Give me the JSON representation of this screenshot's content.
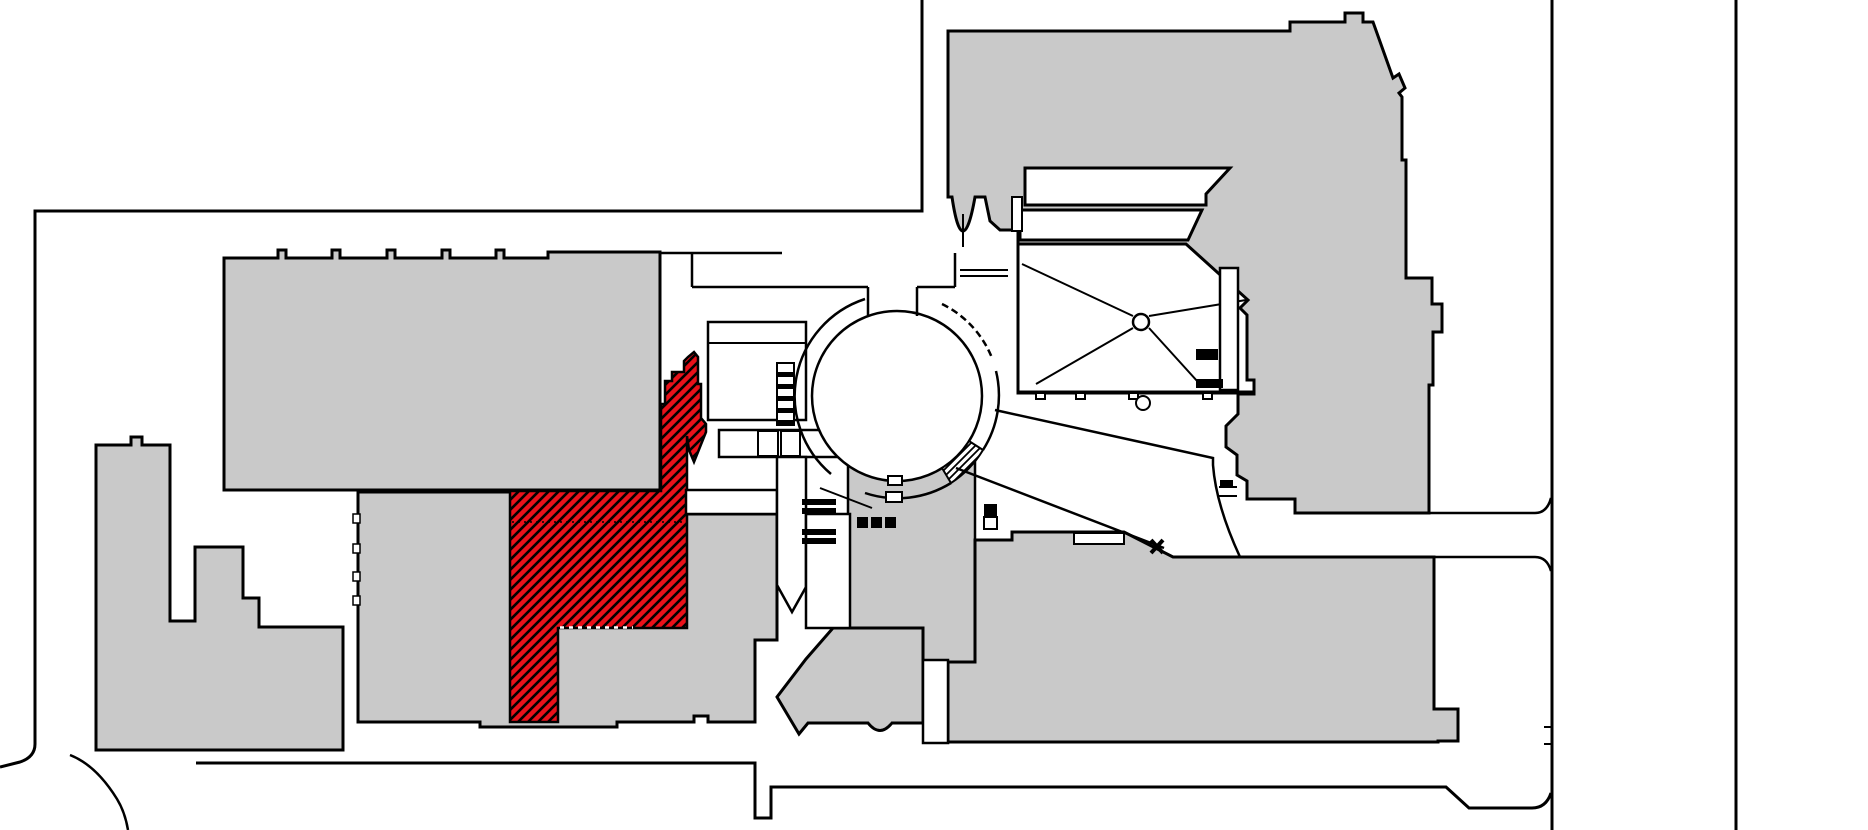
{
  "canvas": {
    "width": 1868,
    "height": 830,
    "background": "#ffffff"
  },
  "palette": {
    "building_fill": "#c9c9c9",
    "outline": "#000000",
    "white": "#ffffff",
    "highlight_red": "#e8111a"
  },
  "highlight": {
    "id": "highlighted-gallery",
    "color": "#e8111a",
    "hatch": "diagonal",
    "selected": true
  },
  "shapes": [
    {
      "name": "site-boundary-north",
      "tag": "path",
      "attrs": {
        "d": "M922,0 V211 H35 V744 Q35,757 20,762 L0,767",
        "fill": "none",
        "stroke": "$outline",
        "stroke-width": 3
      },
      "interactable": false
    },
    {
      "name": "site-boundary-south",
      "tag": "path",
      "attrs": {
        "d": "M196,763 H755 V818 H771 V787 H1446 L1469,808 H1532 Q1546,808 1551,793",
        "fill": "none",
        "stroke": "$outline",
        "stroke-width": 3
      },
      "interactable": false
    },
    {
      "name": "site-path-curve-sw",
      "tag": "path",
      "attrs": {
        "d": "M70,755 C88,762 104,778 117,799 Q125,812 128,830",
        "fill": "none",
        "stroke": "$outline",
        "stroke-width": 2.5
      },
      "interactable": false
    },
    {
      "name": "site-boundary-east-inner",
      "tag": "path",
      "attrs": {
        "d": "M1552,0 V830",
        "fill": "none",
        "stroke": "$outline",
        "stroke-width": 3
      },
      "interactable": false
    },
    {
      "name": "site-boundary-east-gate-ticks",
      "tag": "path",
      "attrs": {
        "d": "M1552,727 H1544 M1552,744 H1544",
        "fill": "none",
        "stroke": "$outline",
        "stroke-width": 2
      },
      "interactable": false
    },
    {
      "name": "site-boundary-east-outer",
      "tag": "path",
      "attrs": {
        "d": "M1736,0 V830",
        "fill": "none",
        "stroke": "$outline",
        "stroke-width": 3
      },
      "interactable": false
    },
    {
      "name": "building-west-wing",
      "tag": "path",
      "attrs": {
        "d": "M224,258 H278 V250 H286 V258 H332 V250 H340 V258 H387 V250 H395 V258 H442 V250 H450 V258 H496 V250 H504 V258 H548 V252 H660 V490 H224 Z",
        "fill": "$building_fill",
        "stroke": "$outline",
        "stroke-width": 3
      },
      "interactable": false
    },
    {
      "name": "building-southwest-towers",
      "tag": "path",
      "attrs": {
        "d": "M96,445 H131 V437 H142 V445 H170 V621 H195 V547 H243 V598 H259 V627 H343 V750 H96 Z",
        "fill": "$building_fill",
        "stroke": "$outline",
        "stroke-width": 3
      },
      "interactable": false
    },
    {
      "name": "building-south-center",
      "tag": "path",
      "attrs": {
        "d": "M358,492 H686 V514 H777 V640 H755 V722 H708 V716 H694 V722 H617 V727 H480 V722 H358 Z",
        "fill": "$building_fill",
        "stroke": "$outline",
        "stroke-width": 3
      },
      "interactable": false
    },
    {
      "name": "building-south-rotunda-block",
      "tag": "rect",
      "attrs": {
        "x": 848,
        "y": 457,
        "width": 127,
        "height": 205,
        "fill": "$building_fill",
        "stroke": "$outline",
        "stroke-width": 2.5
      },
      "interactable": false
    },
    {
      "name": "building-south-mid",
      "tag": "path",
      "attrs": {
        "d": "M833,628 L806,659 L777,697 L799,734 L808,723 H868 Q880,738 892,723 H923 V628 Z",
        "fill": "$building_fill",
        "stroke": "$outline",
        "stroke-width": 3
      },
      "interactable": false
    },
    {
      "name": "building-southeast-wing",
      "tag": "path",
      "attrs": {
        "d": "M948,742 V662 H975 V540 H1012 V532 H1124 L1173,557 H1434 V709 H1458 V741 H1438 V742 Z",
        "fill": "$building_fill",
        "stroke": "$outline",
        "stroke-width": 3
      },
      "interactable": false
    },
    {
      "name": "building-northeast-wing",
      "tag": "path",
      "attrs": {
        "d": "M948,31 H1290 V22 H1345 V13 H1363 V22 H1373 L1393,78 L1399,74 L1405,88 L1399,93 L1402,97 V160 H1406 V278 H1432 V304 H1442 V332 H1433 V385 H1429 V513 H1295 V499 H1247 V481 L1237,475 V455 L1226,447 V426 L1238,414 V394 H1254 V393 H1018 V230 H1000 L990,221 L985,197 H975 Q969,231 963,231 Q957,231 952,197 H948 Z",
        "fill": "$building_fill",
        "stroke": "$outline",
        "stroke-width": 3
      },
      "interactable": false
    },
    {
      "name": "highlighted-gallery",
      "tag": "path",
      "attrs": {
        "d": "M694,352 L698,357 V384 H701 V418 L706,424 L706,432 L698,452 L694,462 L689,450 L687,436 V491 V628 H558 V722 H510 V491 H661 V404 H665 V381 H672 V372 H684 V361 L688,357 Z",
        "fill": "url(#redHatch)",
        "stroke": "$outline",
        "stroke-width": 2.5
      },
      "interactable": true
    },
    {
      "name": "highlighted-gallery-door-dashes",
      "tag": "path",
      "attrs": {
        "d": "M560,627.5 H633",
        "fill": "none",
        "stroke": "$white",
        "stroke-width": 2.5,
        "stroke-dasharray": "4,5"
      },
      "interactable": false
    },
    {
      "name": "highlighted-gallery-inner-dotted",
      "tag": "path",
      "attrs": {
        "d": "M512,522 H685",
        "fill": "none",
        "stroke": "$outline",
        "stroke-width": 1.5,
        "stroke-dasharray": "2,4"
      },
      "interactable": false
    },
    {
      "name": "courtyard-band-upper",
      "tag": "path",
      "attrs": {
        "d": "M1025,168 H1230 L1206,194 V205 H1025 Z",
        "fill": "$white",
        "stroke": "$outline",
        "stroke-width": 3
      },
      "interactable": false
    },
    {
      "name": "courtyard-band-lower",
      "tag": "path",
      "attrs": {
        "d": "M1020,210 H1202 L1188,240 H1020 Z",
        "fill": "$white",
        "stroke": "$outline",
        "stroke-width": 3
      },
      "interactable": false
    },
    {
      "name": "courtyard-radial-hall",
      "tag": "path",
      "attrs": {
        "d": "M1018,244 H1186 L1248,300 L1240,308 L1247,315 V380 H1254 V392 H1018 Z",
        "fill": "$white",
        "stroke": "$outline",
        "stroke-width": 3
      },
      "interactable": false
    },
    {
      "name": "radial-hall-spokes",
      "tag": "path",
      "attrs": {
        "d": "M1133,316 L1022,264 M1133,328 L1036,384 M1149,328 L1198,382 M1149,316 L1246,300",
        "fill": "none",
        "stroke": "$outline",
        "stroke-width": 2
      },
      "interactable": false
    },
    {
      "name": "radial-hall-hub",
      "tag": "circle",
      "attrs": {
        "cx": 1141,
        "cy": 322,
        "r": 8,
        "fill": "$white",
        "stroke": "$outline",
        "stroke-width": 2.5
      },
      "interactable": false
    },
    {
      "name": "courtyard-east-corridor",
      "tag": "rect",
      "attrs": {
        "x": 1220,
        "y": 268,
        "width": 18,
        "height": 122,
        "fill": "$white",
        "stroke": "$outline",
        "stroke-width": 2.5
      },
      "interactable": false
    },
    {
      "name": "courtyard-stair-block-1",
      "tag": "rect",
      "attrs": {
        "x": 1196,
        "y": 349,
        "width": 22,
        "height": 11,
        "fill": "$outline",
        "stroke": "none"
      },
      "interactable": false
    },
    {
      "name": "courtyard-stair-block-2",
      "tag": "rect",
      "attrs": {
        "x": 1196,
        "y": 379,
        "width": 27,
        "height": 9,
        "fill": "$outline",
        "stroke": "none"
      },
      "interactable": false
    },
    {
      "name": "courtyard-closet",
      "tag": "rect",
      "attrs": {
        "x": 1012,
        "y": 197,
        "width": 10,
        "height": 34,
        "fill": "$white",
        "stroke": "$outline",
        "stroke-width": 2
      },
      "interactable": false
    },
    {
      "name": "hall-south-wall-tabs",
      "tag": "path",
      "attrs": {
        "d": "M1036,393 h9 v6 h-9 Z M1076,393 h9 v6 h-9 Z M1129,393 h9 v6 h-9 Z M1203,393 h9 v6 h-9 Z",
        "fill": "$white",
        "stroke": "$outline",
        "stroke-width": 2
      },
      "interactable": false
    },
    {
      "name": "hall-south-pier",
      "tag": "circle",
      "attrs": {
        "cx": 1143,
        "cy": 403,
        "r": 7,
        "fill": "$white",
        "stroke": "$outline",
        "stroke-width": 2
      },
      "interactable": false
    },
    {
      "name": "south-rooms-upper",
      "tag": "rect",
      "attrs": {
        "x": 708,
        "y": 322,
        "width": 98,
        "height": 98,
        "fill": "$white",
        "stroke": "$outline",
        "stroke-width": 2.5
      },
      "interactable": false
    },
    {
      "name": "south-rooms-upper-divider",
      "tag": "path",
      "attrs": {
        "d": "M708,343 H806",
        "fill": "none",
        "stroke": "$outline",
        "stroke-width": 2
      },
      "interactable": false
    },
    {
      "name": "south-rooms-row",
      "tag": "rect",
      "attrs": {
        "x": 719,
        "y": 430,
        "width": 128,
        "height": 27,
        "fill": "$white",
        "stroke": "$outline",
        "stroke-width": 2.5
      },
      "interactable": false
    },
    {
      "name": "south-corridor-band",
      "tag": "rect",
      "attrs": {
        "x": 686,
        "y": 490,
        "width": 91,
        "height": 24,
        "fill": "$white",
        "stroke": "$outline",
        "stroke-width": 2.5
      },
      "interactable": false
    },
    {
      "name": "south-lightwell-slot",
      "tag": "path",
      "attrs": {
        "d": "M777,457 H806 V587 L792,612 L777,585 Z",
        "fill": "$white",
        "stroke": "$outline",
        "stroke-width": 2.5
      },
      "interactable": false
    },
    {
      "name": "south-lightwell-mid",
      "tag": "rect",
      "attrs": {
        "x": 806,
        "y": 514,
        "width": 44,
        "height": 114,
        "fill": "$white",
        "stroke": "$outline",
        "stroke-width": 2.5
      },
      "interactable": false
    },
    {
      "name": "south-stair-bars",
      "tag": "path",
      "attrs": {
        "d": "M802,499 h34 v6 h-34 Z M802,508 h34 v6 h-34 Z M802,529 h34 v6 h-34 Z M802,538 h34 v6 h-34 Z",
        "fill": "$outline",
        "stroke": "none"
      },
      "interactable": false
    },
    {
      "name": "south-stair-squares",
      "tag": "path",
      "attrs": {
        "d": "M857,517 h11 v11 h-11 Z M871,517 h11 v11 h-11 Z M885,517 h11 v11 h-11 Z",
        "fill": "$outline",
        "stroke": "none"
      },
      "interactable": false
    },
    {
      "name": "southeast-stair-block",
      "tag": "rect",
      "attrs": {
        "x": 984,
        "y": 504,
        "width": 13,
        "height": 13,
        "fill": "$outline",
        "stroke": "none"
      },
      "interactable": false
    },
    {
      "name": "southeast-stair-landing",
      "tag": "rect",
      "attrs": {
        "x": 984,
        "y": 517,
        "width": 13,
        "height": 12,
        "fill": "$white",
        "stroke": "$outline",
        "stroke-width": 2
      },
      "interactable": false
    },
    {
      "name": "southeast-skylight",
      "tag": "rect",
      "attrs": {
        "x": 1074,
        "y": 533,
        "width": 50,
        "height": 11,
        "fill": "$white",
        "stroke": "$outline",
        "stroke-width": 2
      },
      "interactable": false
    },
    {
      "name": "lightwell-between-wings",
      "tag": "rect",
      "attrs": {
        "x": 923,
        "y": 660,
        "width": 25,
        "height": 83,
        "fill": "$white",
        "stroke": "$outline",
        "stroke-width": 2.5
      },
      "interactable": false
    },
    {
      "name": "south-center-facade-ticks",
      "tag": "path",
      "attrs": {
        "d": "M353,514 h7 v9 h-7 Z M353,544 h7 v9 h-7 Z M353,572 h7 v9 h-7 Z M353,596 h7 v9 h-7 Z",
        "fill": "$white",
        "stroke": "$outline",
        "stroke-width": 1.5
      },
      "interactable": false
    },
    {
      "name": "rotunda-floor",
      "tag": "circle",
      "attrs": {
        "cx": 897,
        "cy": 396,
        "r": 85,
        "fill": "$white",
        "stroke": "$outline",
        "stroke-width": 2.5
      },
      "interactable": false
    },
    {
      "name": "rotunda-ring-west",
      "tag": "path",
      "attrs": {
        "d": "M865,299 A102,102 0 0 0 831,474",
        "fill": "none",
        "stroke": "$outline",
        "stroke-width": 2.5
      },
      "interactable": false
    },
    {
      "name": "rotunda-ring-northeast",
      "tag": "path",
      "attrs": {
        "d": "M942,304 A102,102 0 0 1 992,358",
        "fill": "none",
        "stroke": "$outline",
        "stroke-width": 2.5,
        "stroke-dasharray": "7,4"
      },
      "interactable": false
    },
    {
      "name": "rotunda-ring-east",
      "tag": "path",
      "attrs": {
        "d": "M996,371 A102,102 0 0 1 983,450",
        "fill": "none",
        "stroke": "$outline",
        "stroke-width": 2.5
      },
      "interactable": false
    },
    {
      "name": "rotunda-ring-south",
      "tag": "path",
      "attrs": {
        "d": "M951,483 A102,102 0 0 1 865,493",
        "fill": "none",
        "stroke": "$outline",
        "stroke-width": 2.5
      },
      "interactable": false
    },
    {
      "name": "rotunda-stair-sector",
      "tag": "path",
      "attrs": {
        "d": "M969,441 A85,85 0 0 1 942,468 L951,483 A102,102 0 0 0 983,450 Z",
        "fill": "url(#blackHatch)",
        "stroke": "$outline",
        "stroke-width": 2
      },
      "interactable": false
    },
    {
      "name": "rotunda-south-tab",
      "tag": "rect",
      "attrs": {
        "x": 886,
        "y": 492,
        "width": 16,
        "height": 10,
        "fill": "$white",
        "stroke": "$outline",
        "stroke-width": 2
      },
      "interactable": false
    },
    {
      "name": "rotunda-inner-tab",
      "tag": "rect",
      "attrs": {
        "x": 888,
        "y": 476,
        "width": 14,
        "height": 9,
        "fill": "$white",
        "stroke": "$outline",
        "stroke-width": 2
      },
      "interactable": false
    },
    {
      "name": "north-room-walls",
      "tag": "path",
      "attrs": {
        "d": "M660,253 H782 M692,253 V287 M692,287 H868 M868,287 V316 M917,287 H955 M917,287 V316 M955,287 V253",
        "fill": "none",
        "stroke": "$outline",
        "stroke-width": 2.5
      },
      "interactable": false
    },
    {
      "name": "north-link-walls",
      "tag": "path",
      "attrs": {
        "d": "M963,214 V247 M960,270 H1008 M960,276 H1008",
        "fill": "none",
        "stroke": "$outline",
        "stroke-width": 2
      },
      "interactable": false
    },
    {
      "name": "west-stair-ladder",
      "tag": "rect",
      "attrs": {
        "x": 777,
        "y": 363,
        "width": 17,
        "height": 62,
        "fill": "$white",
        "stroke": "$outline",
        "stroke-width": 2
      },
      "interactable": false
    },
    {
      "name": "west-stair-rungs",
      "tag": "path",
      "attrs": {
        "d": "M777,372 h17 v5 h-17 Z M777,384 h17 v5 h-17 Z M777,396 h17 v5 h-17 Z M777,408 h17 v5 h-17 Z M777,420 h17 v5 h-17 Z",
        "fill": "$outline",
        "stroke": "none"
      },
      "interactable": false
    },
    {
      "name": "southwest-rotunda-rooms",
      "tag": "path",
      "attrs": {
        "d": "M758,431 h20 v25 h-20 Z M781,431 h19 v25 h-19 Z",
        "fill": "$white",
        "stroke": "$outline",
        "stroke-width": 2
      },
      "interactable": false
    },
    {
      "name": "corridor-diagonal-upper",
      "tag": "path",
      "attrs": {
        "d": "M995,410 L1213,458 V465 Q1216,505 1240,557",
        "fill": "none",
        "stroke": "$outline",
        "stroke-width": 2.5
      },
      "interactable": false
    },
    {
      "name": "corridor-diagonal-lower",
      "tag": "path",
      "attrs": {
        "d": "M956,468 L1164,548",
        "fill": "none",
        "stroke": "$outline",
        "stroke-width": 2.5
      },
      "interactable": false
    },
    {
      "name": "corridor-door-cross",
      "tag": "path",
      "attrs": {
        "d": "M1151,540 L1163,553 M1163,540 L1151,553",
        "fill": "none",
        "stroke": "$outline",
        "stroke-width": 4
      },
      "interactable": false
    },
    {
      "name": "corridor-bridge-lines",
      "tag": "path",
      "attrs": {
        "d": "M1219,487 H1237 M1219,496 H1237",
        "fill": "none",
        "stroke": "$outline",
        "stroke-width": 2
      },
      "interactable": false
    },
    {
      "name": "corridor-bridge-door",
      "tag": "rect",
      "attrs": {
        "x": 1220,
        "y": 480,
        "width": 13,
        "height": 7,
        "fill": "$outline",
        "stroke": "none"
      },
      "interactable": false
    },
    {
      "name": "east-corridor-upper-line",
      "tag": "path",
      "attrs": {
        "d": "M1429,513 H1535 Q1547,513 1551,498",
        "fill": "none",
        "stroke": "$outline",
        "stroke-width": 2.5
      },
      "interactable": false
    },
    {
      "name": "east-corridor-lower-line",
      "tag": "path",
      "attrs": {
        "d": "M1434,557 H1535 Q1547,557 1551,571",
        "fill": "none",
        "stroke": "$outline",
        "stroke-width": 2.5
      },
      "interactable": false
    },
    {
      "name": "southwest-rotunda-wall",
      "tag": "path",
      "attrs": {
        "d": "M820,488 L872,508",
        "fill": "none",
        "stroke": "$outline",
        "stroke-width": 2
      },
      "interactable": false
    }
  ]
}
